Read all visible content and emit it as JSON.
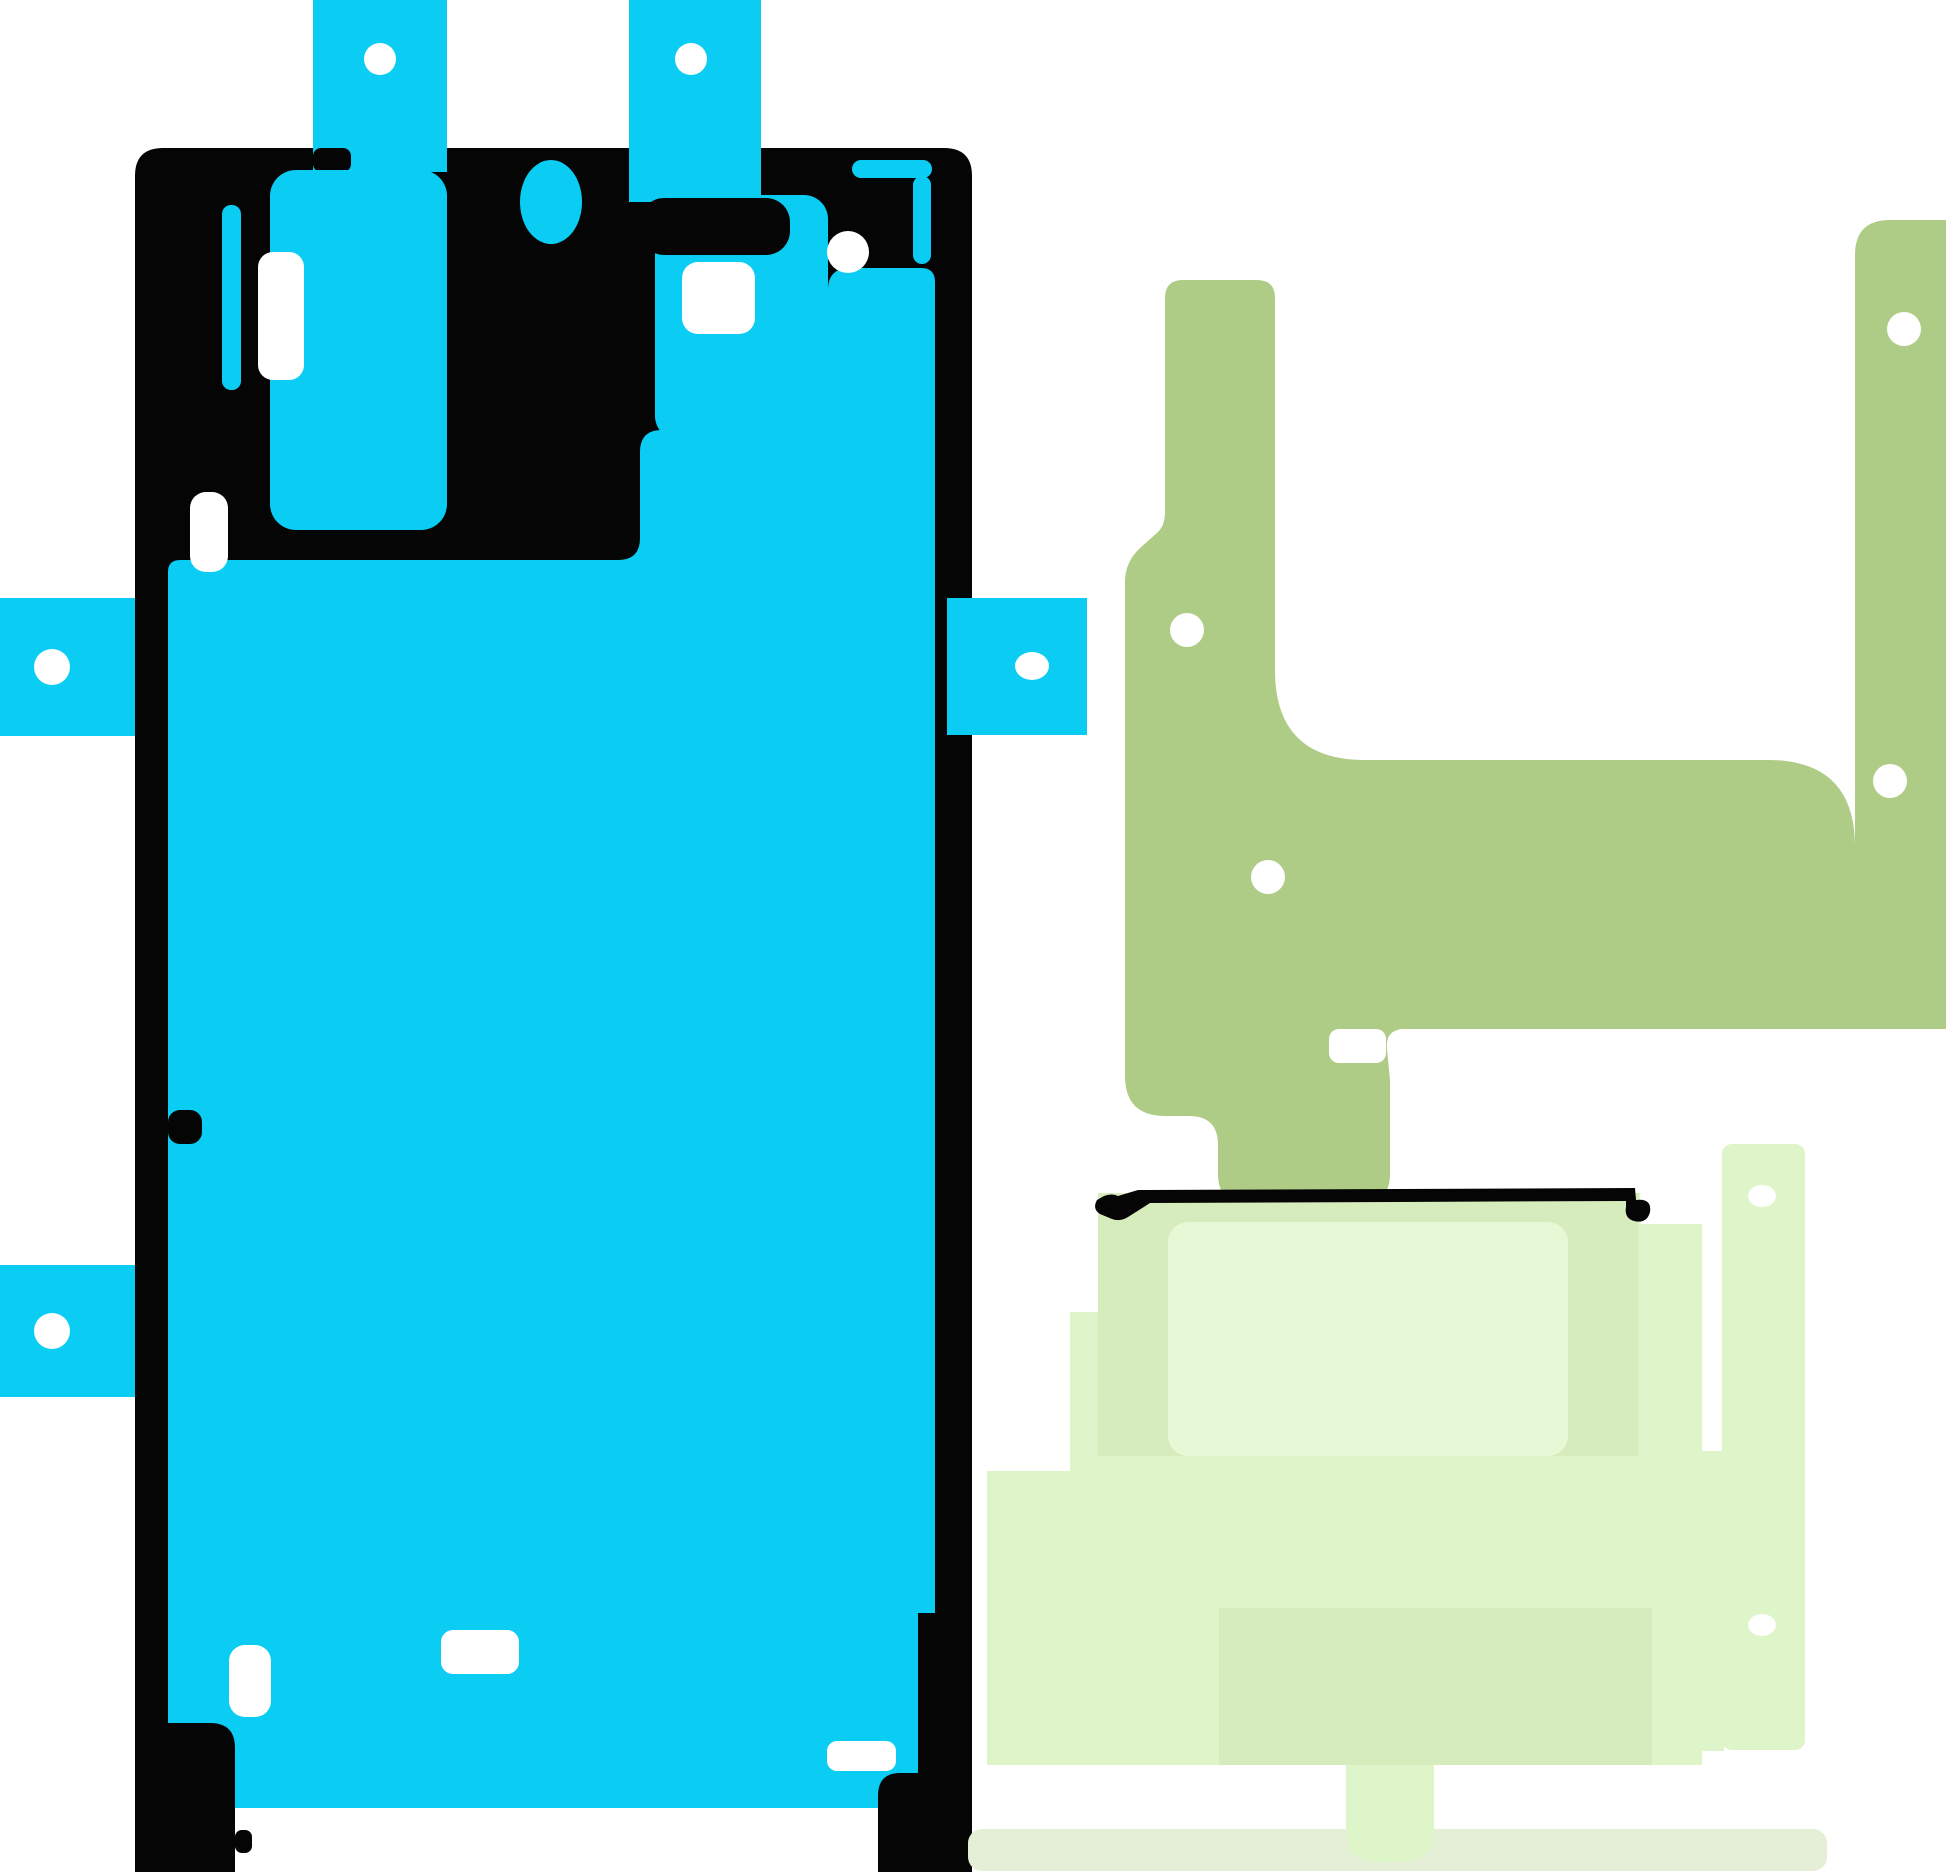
{
  "background": "#FFFFFF",
  "colors": {
    "cyan": "#0BCDF3",
    "outline": "#050505",
    "hole": "#FFFFFF",
    "olive": "#AECC85",
    "pale": "#DEF4C9",
    "pale_shade": "#D6ECBD",
    "pale_highlight": "#E6F8D5",
    "pale_strip": "#E4EFD6"
  },
  "parts": {
    "display_adhesive": "front display adhesive with pull tabs",
    "rear_adhesive": "U-shaped rear housing adhesive",
    "battery_stack": "layered battery adhesive stack"
  },
  "counts": {
    "pull_tabs": 5,
    "alignment_holes_display": 5,
    "alignment_holes_rear": 4,
    "alignment_holes_stack": 2
  }
}
